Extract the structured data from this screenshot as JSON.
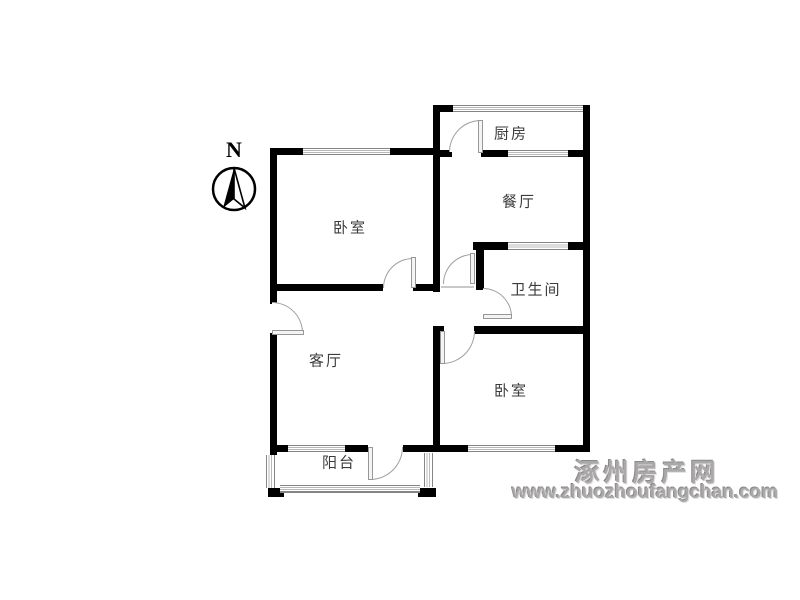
{
  "title": "apartment-floor-plan",
  "compass": {
    "label": "N"
  },
  "rooms": {
    "kitchen": {
      "label": "厨房"
    },
    "dining": {
      "label": "餐厅"
    },
    "bedroom_nw": {
      "label": "卧室"
    },
    "bathroom": {
      "label": "卫生间"
    },
    "living": {
      "label": "客厅"
    },
    "bedroom_se": {
      "label": "卧室"
    },
    "balcony": {
      "label": "阳台"
    }
  },
  "watermark": {
    "site_name": "涿州房产网",
    "site_url": "www.zhuozhoufangchan.com",
    "color": "#aaa8a8"
  },
  "colors": {
    "wall": "#000000",
    "door": "#9f9f9f",
    "window_frame": "#858585",
    "room_label": "#3c3c3c",
    "background": "#ffffff"
  }
}
